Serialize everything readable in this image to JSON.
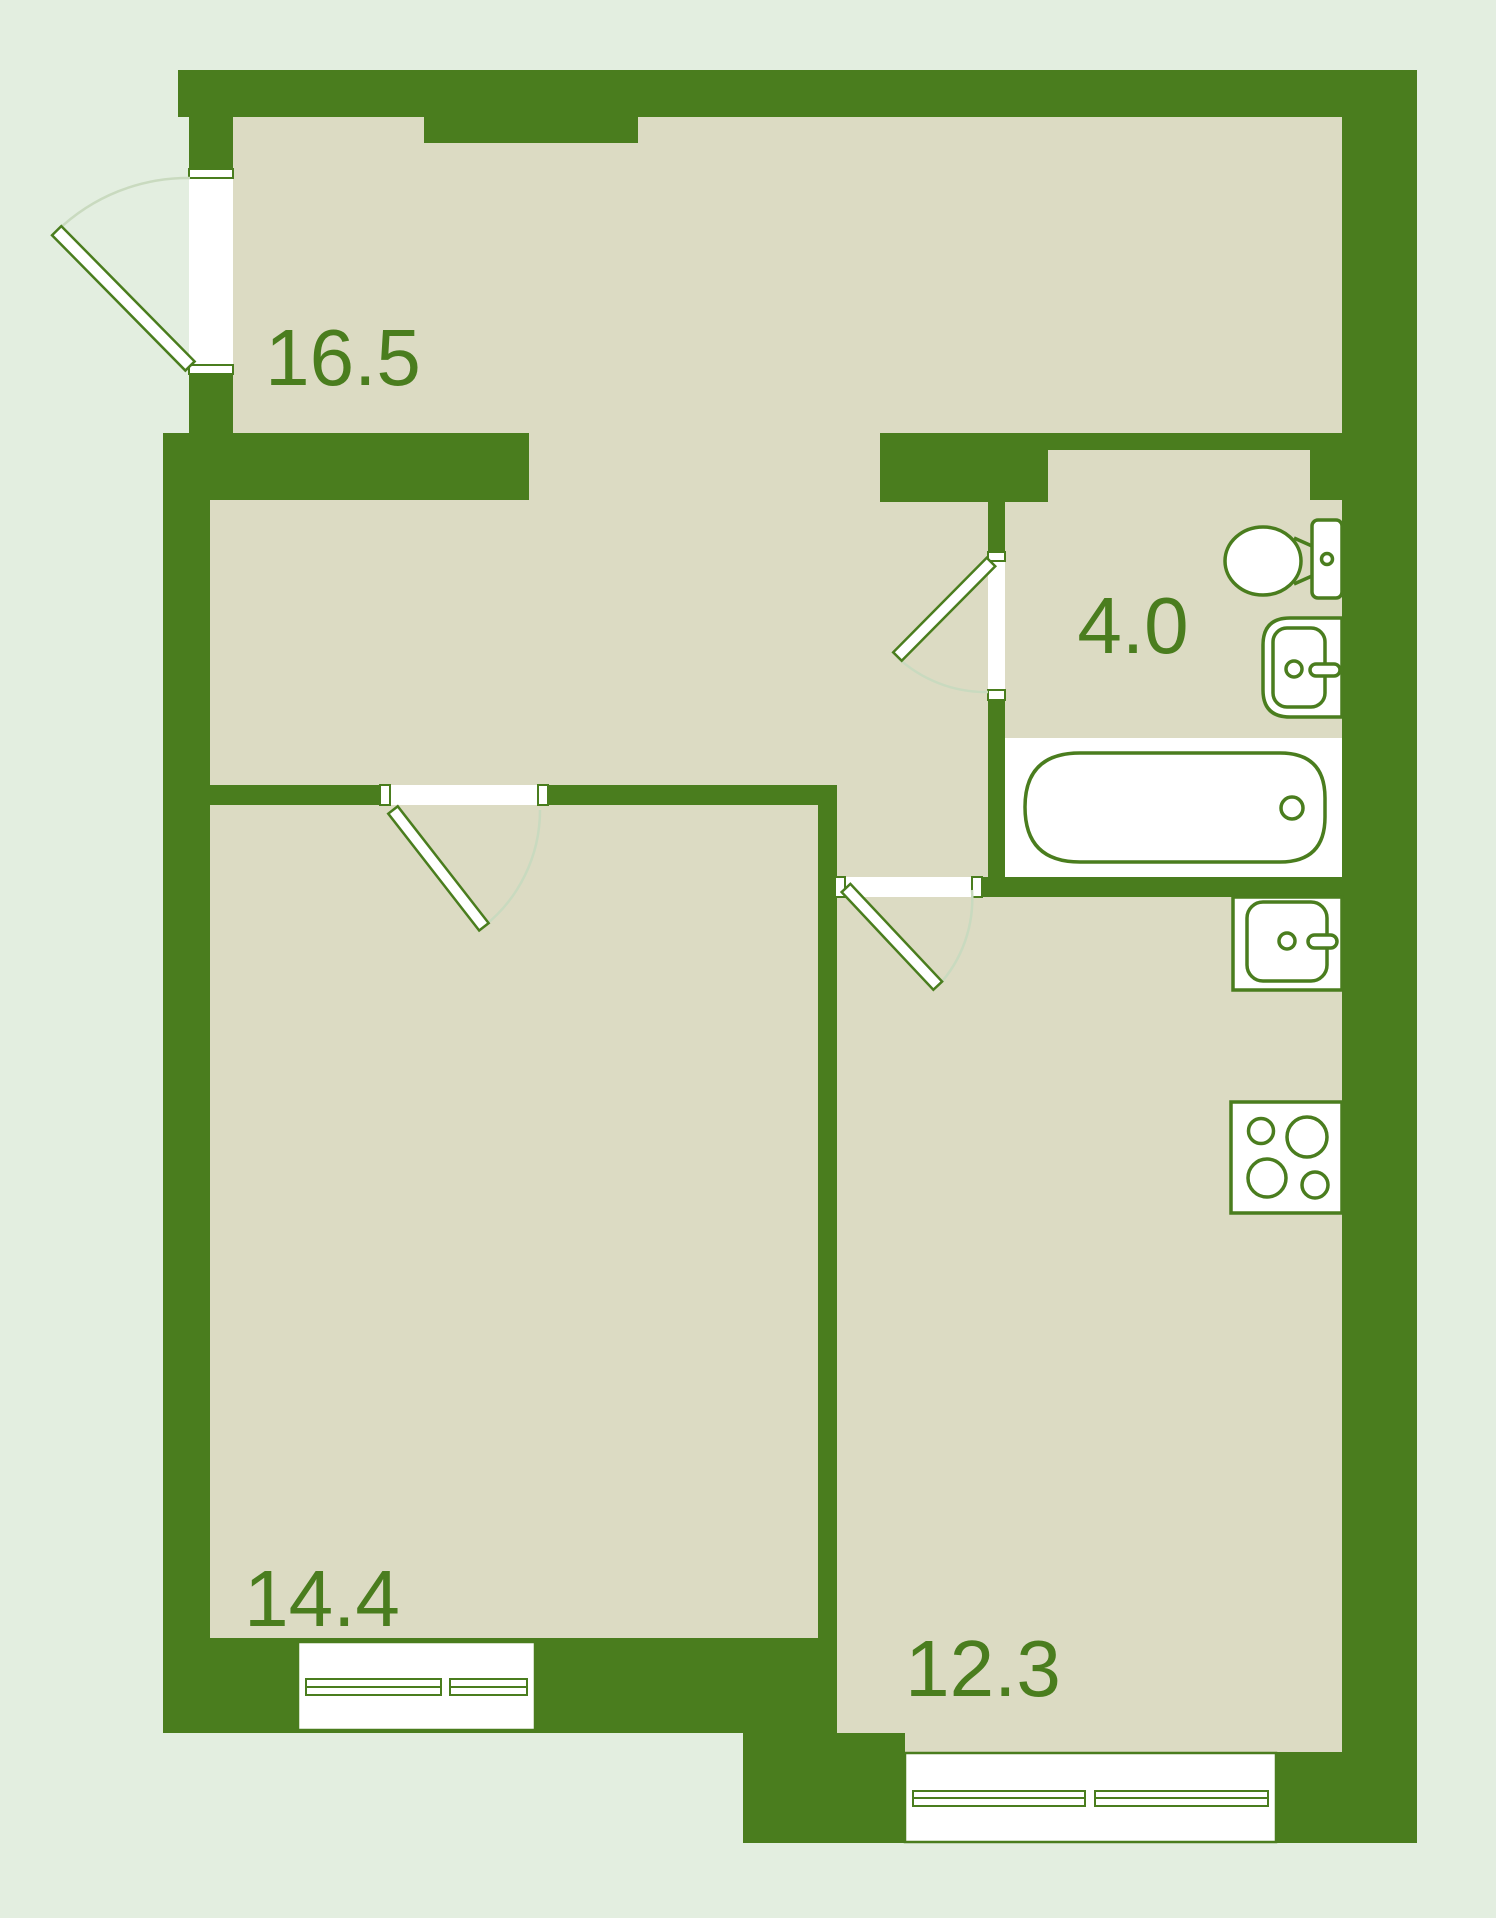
{
  "plan": {
    "type": "apartment-floor-plan",
    "rooms": [
      {
        "id": "living-room",
        "label": "16.5",
        "area_sq_m": 16.5
      },
      {
        "id": "bathroom",
        "label": "4.0",
        "area_sq_m": 4.0
      },
      {
        "id": "bedroom",
        "label": "14.4",
        "area_sq_m": 14.4
      },
      {
        "id": "kitchen",
        "label": "12.3",
        "area_sq_m": 12.3
      }
    ],
    "fixtures": [
      "toilet",
      "washbasin",
      "bathtub",
      "kitchen-sink",
      "stove-hob"
    ],
    "openings": [
      "entrance-door",
      "bathroom-door",
      "bedroom-door",
      "kitchen-door",
      "bedroom-window",
      "kitchen-window"
    ],
    "colors": {
      "background": "#e3eee0",
      "wall": "#4a7d1e",
      "floor": "#dcdbc3",
      "label": "#4a7d1e",
      "fixture_fill": "#ffffff",
      "door_swing_arc": "#c9dabf"
    }
  }
}
